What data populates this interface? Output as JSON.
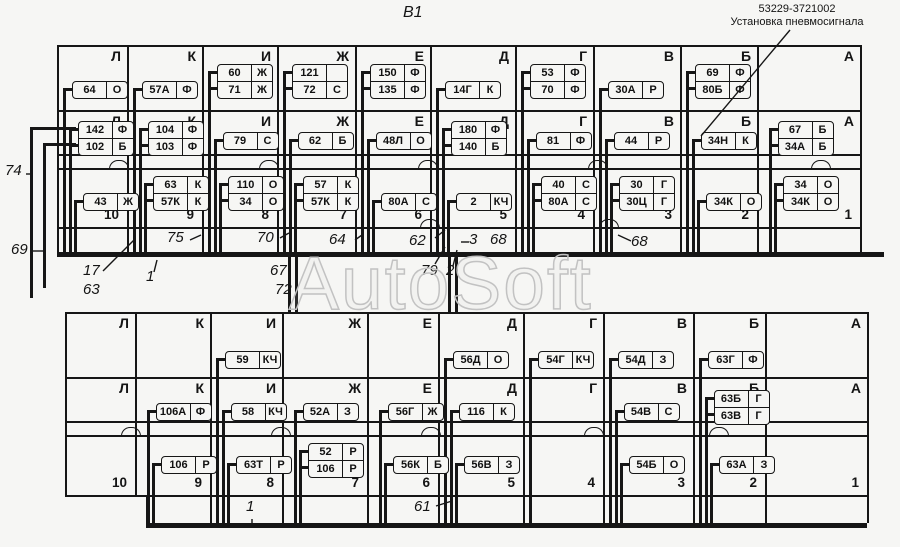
{
  "title": "В1",
  "watermark": "AutoSoft",
  "annotation": {
    "part_number": "53229-3721002",
    "caption": "Установка пневмосигнала"
  },
  "colors": {
    "ink": "#161616",
    "background": "#f6f6f4",
    "watermark_outline": "#c2c2c2"
  },
  "column_letters": [
    "Л",
    "К",
    "И",
    "Ж",
    "Е",
    "Д",
    "Г",
    "В",
    "Б",
    "А"
  ],
  "cell_numbers": [
    "10",
    "9",
    "8",
    "7",
    "6",
    "5",
    "4",
    "3",
    "2",
    "1"
  ],
  "top_grid": {
    "rows": [
      [
        [
          {
            "num": "64",
            "code": "О"
          }
        ],
        [
          {
            "num": "57А",
            "code": "Ф"
          }
        ],
        [
          {
            "num": "60",
            "code": "Ж"
          },
          {
            "num": "71",
            "code": "Ж"
          }
        ],
        [
          {
            "num": "121",
            "code": ""
          },
          {
            "num": "72",
            "code": "С"
          }
        ],
        [
          {
            "num": "150",
            "code": "Ф"
          },
          {
            "num": "135",
            "code": "Ф"
          }
        ],
        [
          {
            "num": "14Г",
            "code": "К"
          }
        ],
        [
          {
            "num": "53",
            "code": "Ф"
          },
          {
            "num": "70",
            "code": "Ф"
          }
        ],
        [
          {
            "num": "30А",
            "code": "Р"
          }
        ],
        [
          {
            "num": "69",
            "code": "Ф"
          },
          {
            "num": "80Б",
            "code": "Ф"
          }
        ],
        []
      ],
      [
        [
          {
            "num": "142",
            "code": "Ф"
          },
          {
            "num": "102",
            "code": "Б"
          }
        ],
        [
          {
            "num": "104",
            "code": "Ф"
          },
          {
            "num": "103",
            "code": "Ф"
          }
        ],
        [
          {
            "num": "79",
            "code": "С"
          }
        ],
        [
          {
            "num": "62",
            "code": "Б"
          }
        ],
        [
          {
            "num": "48Л",
            "code": "О"
          }
        ],
        [
          {
            "num": "180",
            "code": "Ф"
          },
          {
            "num": "140",
            "code": "Б"
          }
        ],
        [
          {
            "num": "81",
            "code": "Ф"
          }
        ],
        [
          {
            "num": "44",
            "code": "Р"
          }
        ],
        [
          {
            "num": "34Н",
            "code": "К"
          }
        ],
        [
          {
            "num": "67",
            "code": "Б"
          },
          {
            "num": "34А",
            "code": "Б"
          }
        ]
      ],
      [
        [
          {
            "num": "43",
            "code": "Ж"
          }
        ],
        [
          {
            "num": "63",
            "code": "К"
          },
          {
            "num": "57К",
            "code": "К"
          }
        ],
        [
          {
            "num": "110",
            "code": "О"
          },
          {
            "num": "34",
            "code": "О"
          }
        ],
        [
          {
            "num": "57",
            "code": "К"
          },
          {
            "num": "57К",
            "code": "К"
          }
        ],
        [
          {
            "num": "80А",
            "code": "С"
          }
        ],
        [
          {
            "num": "2",
            "code": "КЧ"
          }
        ],
        [
          {
            "num": "40",
            "code": "С"
          },
          {
            "num": "80А",
            "code": "С"
          }
        ],
        [
          {
            "num": "30",
            "code": "Г"
          },
          {
            "num": "30Ц",
            "code": "Г"
          }
        ],
        [
          {
            "num": "34К",
            "code": "О"
          }
        ],
        [
          {
            "num": "34",
            "code": "О"
          },
          {
            "num": "34К",
            "code": "О"
          }
        ]
      ]
    ]
  },
  "bottom_grid": {
    "rows": [
      [
        [],
        [],
        [
          {
            "num": "59",
            "code": "КЧ"
          }
        ],
        [],
        [],
        [
          {
            "num": "56Д",
            "code": "О"
          }
        ],
        [
          {
            "num": "54Г",
            "code": "КЧ"
          }
        ],
        [
          {
            "num": "54Д",
            "code": "З"
          }
        ],
        [
          {
            "num": "63Г",
            "code": "Ф"
          }
        ],
        []
      ],
      [
        [],
        [
          {
            "num": "106А",
            "code": "Ф"
          }
        ],
        [
          {
            "num": "58",
            "code": "КЧ"
          }
        ],
        [
          {
            "num": "52А",
            "code": "З"
          }
        ],
        [
          {
            "num": "56Г",
            "code": "Ж"
          }
        ],
        [
          {
            "num": "116",
            "code": "К"
          }
        ],
        [],
        [
          {
            "num": "54В",
            "code": "С"
          }
        ],
        [
          {
            "num": "63Б",
            "code": "Г"
          },
          {
            "num": "63В",
            "code": "Г"
          }
        ],
        []
      ],
      [
        [],
        [
          {
            "num": "106",
            "code": "Р"
          }
        ],
        [
          {
            "num": "63Т",
            "code": "Р"
          }
        ],
        [
          {
            "num": "52",
            "code": "Р"
          },
          {
            "num": "106",
            "code": "Р"
          }
        ],
        [
          {
            "num": "56К",
            "code": "Б"
          }
        ],
        [
          {
            "num": "56В",
            "code": "З"
          }
        ],
        [],
        [
          {
            "num": "54Б",
            "code": "О"
          }
        ],
        [
          {
            "num": "63А",
            "code": "З"
          }
        ],
        []
      ]
    ]
  },
  "callouts": [
    {
      "id": "c74",
      "label": "74"
    },
    {
      "id": "c69",
      "label": "69"
    },
    {
      "id": "c17",
      "label": "17"
    },
    {
      "id": "c63",
      "label": "63"
    },
    {
      "id": "c1top",
      "label": "1"
    },
    {
      "id": "c75",
      "label": "75"
    },
    {
      "id": "c70",
      "label": "70"
    },
    {
      "id": "c64",
      "label": "64"
    },
    {
      "id": "c62",
      "label": "62"
    },
    {
      "id": "c3",
      "label": "3"
    },
    {
      "id": "c68a",
      "label": "68"
    },
    {
      "id": "c68b",
      "label": "68"
    },
    {
      "id": "c67",
      "label": "67"
    },
    {
      "id": "c72",
      "label": "72"
    },
    {
      "id": "c79",
      "label": "79"
    },
    {
      "id": "c2",
      "label": "2"
    },
    {
      "id": "c1bot",
      "label": "1"
    },
    {
      "id": "c61",
      "label": "61"
    }
  ]
}
